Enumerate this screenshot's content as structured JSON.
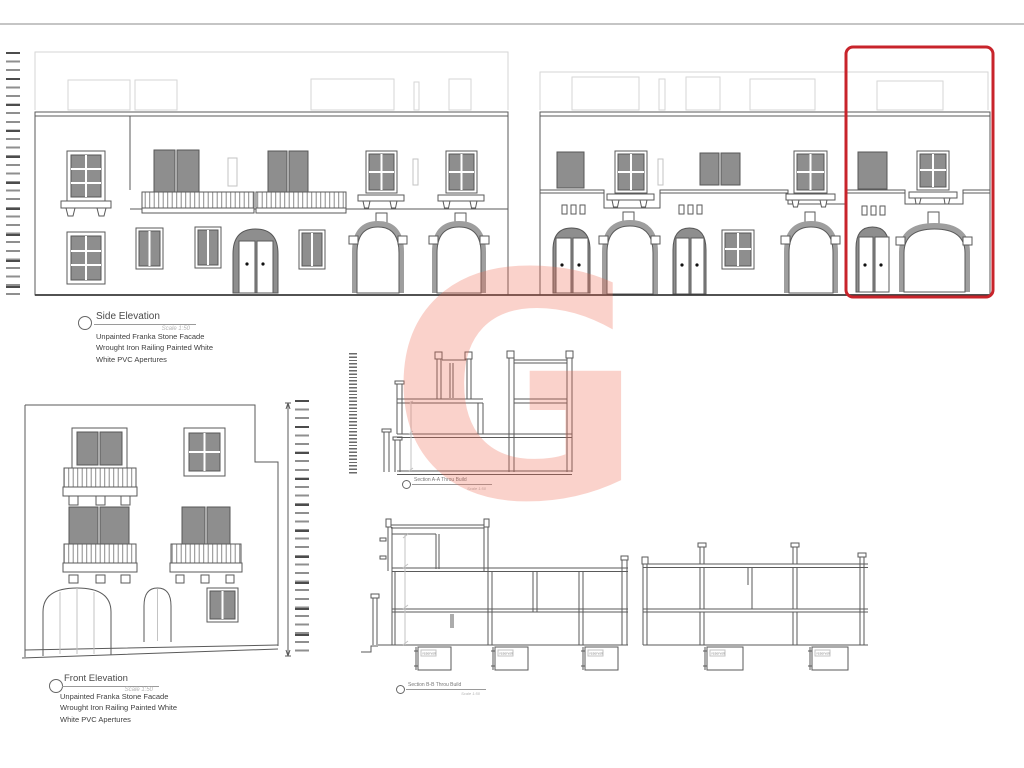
{
  "page": {
    "background": "#ffffff",
    "divider_color": "#c5c5c5"
  },
  "watermark": {
    "letter": "G",
    "color": "#ef6a52"
  },
  "highlight": {
    "color": "#c8242b"
  },
  "labels": {
    "side": {
      "title": "Side Elevation",
      "scale": "Scale 1:50",
      "notes": [
        "Unpainted Franka Stone Facade",
        "Wrought Iron Railing Painted White",
        "White PVC Apertures"
      ]
    },
    "front": {
      "title": "Front Elevation",
      "scale": "Scale 1:50",
      "notes": [
        "Unpainted Franka Stone Facade",
        "Wrought Iron Railing Painted White",
        "White PVC Apertures"
      ]
    },
    "section_a": {
      "title": "Section A-A Throu Build",
      "scale": "Scale 1:50"
    },
    "section_b": {
      "title": "Section B-B Throu Build",
      "scale": "Scale 1:50"
    },
    "reservoir": "reservoir"
  }
}
